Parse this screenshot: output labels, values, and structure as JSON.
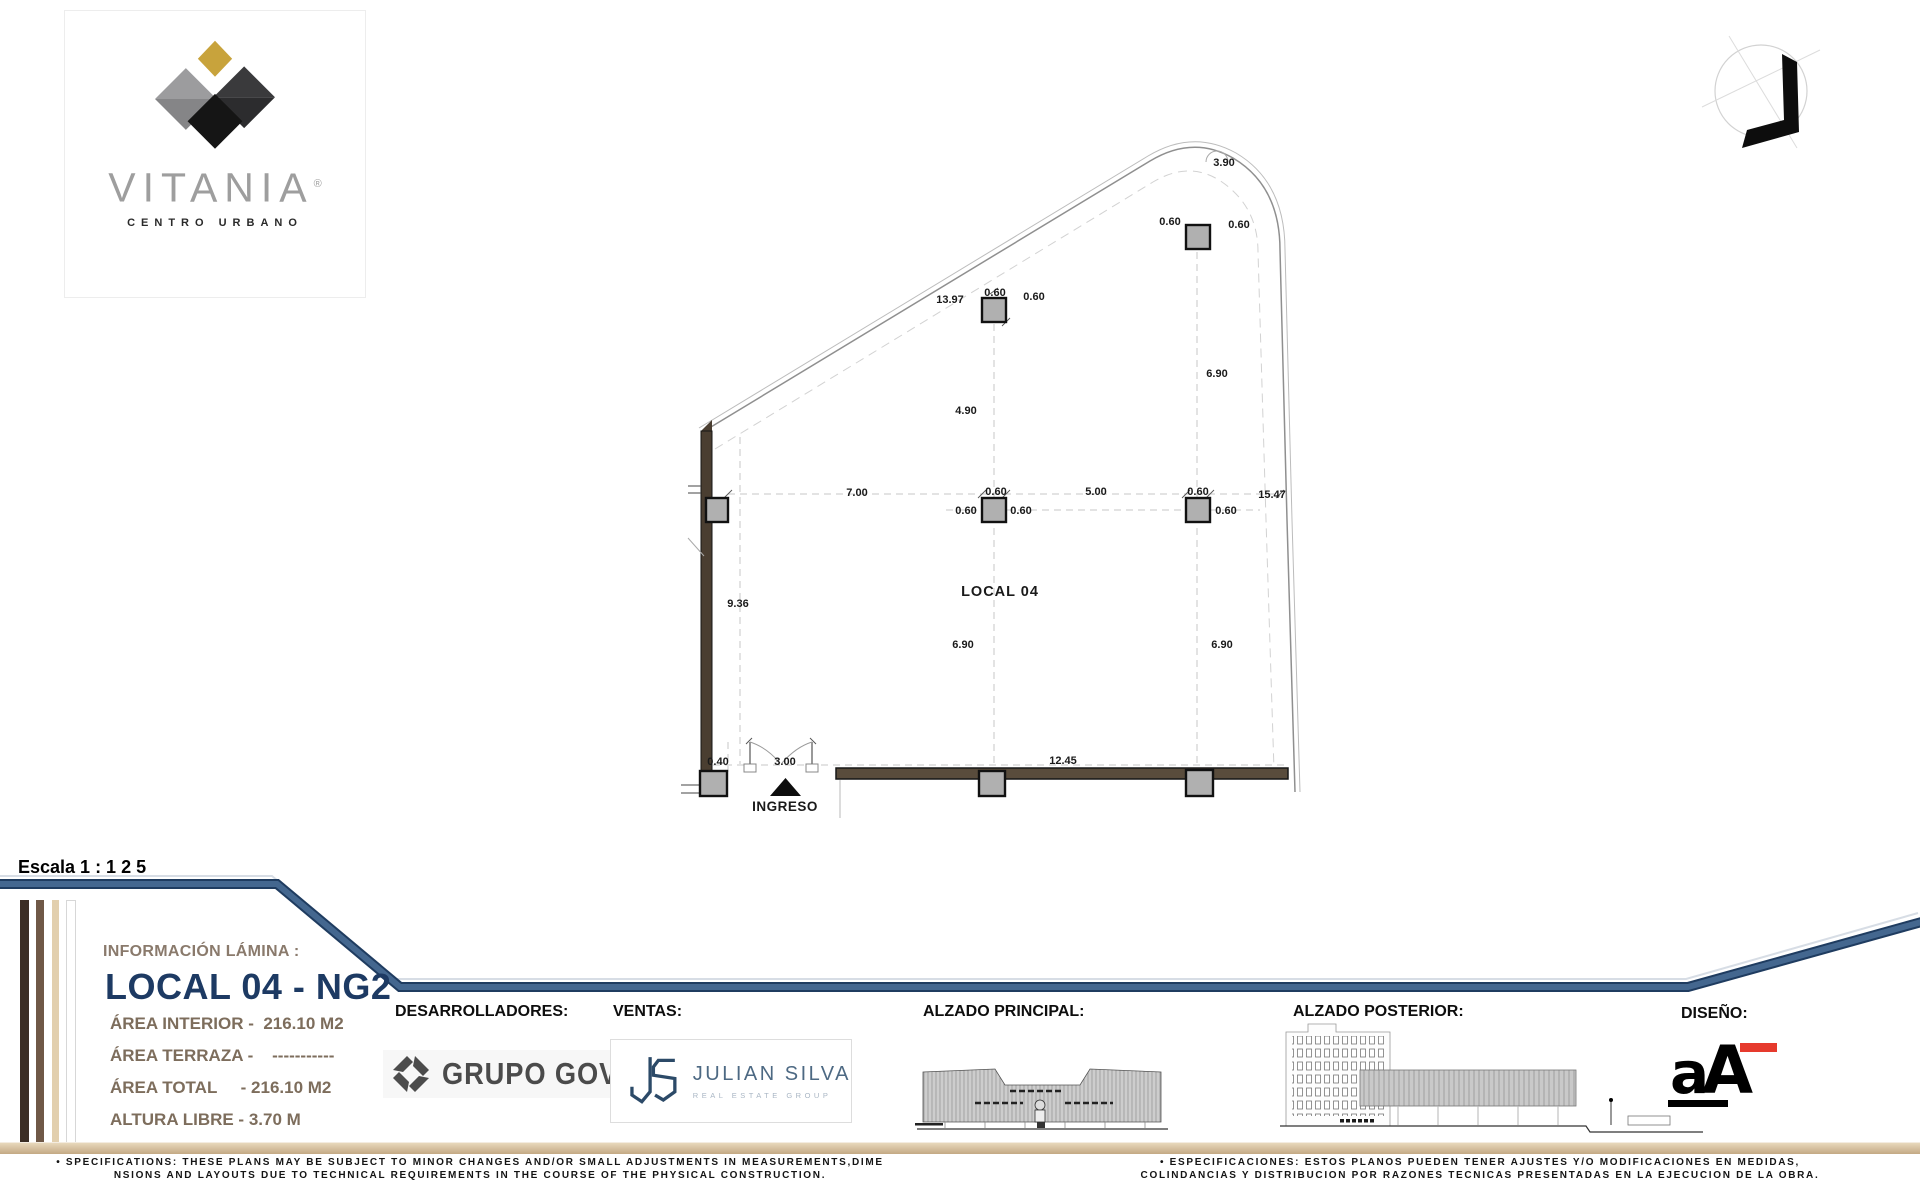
{
  "brand": {
    "name": "VITANIA",
    "registered": "®",
    "tagline": "CENTRO URBANO"
  },
  "scale_label": "Escala 1 : 1 2 5",
  "plan": {
    "labels": [
      {
        "t": "3.90",
        "x": 1224,
        "y": 166
      },
      {
        "t": "13.97",
        "x": 950,
        "y": 303
      },
      {
        "t": "0.60",
        "x": 995,
        "y": 296
      },
      {
        "t": "0.60",
        "x": 1034,
        "y": 300
      },
      {
        "t": "0.60",
        "x": 1170,
        "y": 225
      },
      {
        "t": "0.60",
        "x": 1239,
        "y": 228
      },
      {
        "t": "6.90",
        "x": 1217,
        "y": 377
      },
      {
        "t": "4.90",
        "x": 966,
        "y": 414
      },
      {
        "t": "7.00",
        "x": 857,
        "y": 496
      },
      {
        "t": "5.00",
        "x": 1096,
        "y": 495
      },
      {
        "t": "15.47",
        "x": 1272,
        "y": 498
      },
      {
        "t": "0.60",
        "x": 996,
        "y": 495
      },
      {
        "t": "0.60",
        "x": 966,
        "y": 514
      },
      {
        "t": "0.60",
        "x": 1021,
        "y": 514
      },
      {
        "t": "0.60",
        "x": 1198,
        "y": 495
      },
      {
        "t": "0.60",
        "x": 1226,
        "y": 514
      },
      {
        "t": "9.36",
        "x": 738,
        "y": 607
      },
      {
        "t": "6.90",
        "x": 963,
        "y": 648
      },
      {
        "t": "6.90",
        "x": 1222,
        "y": 648
      },
      {
        "t": "0.40",
        "x": 718,
        "y": 765
      },
      {
        "t": "3.00",
        "x": 785,
        "y": 765
      },
      {
        "t": "12.45",
        "x": 1063,
        "y": 764
      },
      {
        "t": "LOCAL 04",
        "x": 1000,
        "y": 596,
        "cls": "room"
      },
      {
        "t": "INGRESO",
        "x": 785,
        "y": 811,
        "cls": "entrance"
      }
    ]
  },
  "info_panel": {
    "heading": "INFORMACIÓN LÁMINA :",
    "title": "LOCAL 04 - NG2",
    "rows": [
      "ÁREA INTERIOR -  216.10 M2",
      "ÁREA TERRAZA -    -----------",
      "ÁREA TOTAL     - 216.10 M2",
      "ALTURA LIBRE - 3.70 M"
    ]
  },
  "sections": {
    "developers_label": "DESARROLLADORES:",
    "sales_label": "VENTAS:",
    "front_elevation_label": "ALZADO PRINCIPAL:",
    "rear_elevation_label": "ALZADO POSTERIOR:",
    "design_label": "DISEÑO:"
  },
  "logos": {
    "developer_name": "GRUPO GOVA",
    "sales_name": "JULIAN SILVA",
    "sales_subtitle": "REAL ESTATE GROUP",
    "design_a": "a",
    "design_cap": "A"
  },
  "footer": {
    "specs_en": [
      "• SPECIFICATIONS: THESE PLANS MAY BE SUBJECT TO MINOR CHANGES AND/OR SMALL ADJUSTMENTS IN MEASUREMENTS,DIME",
      "NSIONS AND LAYOUTS DUE TO TECHNICAL REQUIREMENTS IN THE COURSE OF THE PHYSICAL CONSTRUCTION."
    ],
    "specs_es": [
      "• ESPECIFICACIONES: ESTOS PLANOS PUEDEN TENER AJUSTES Y/O MODIFICACIONES EN MEDIDAS,",
      "COLINDANCIAS Y DISTRIBUCION POR RAZONES TECNICAS PRESENTADAS EN LA EJECUCION DE LA OBRA."
    ]
  },
  "colors": {
    "accent_blue": "#44678f",
    "navy_title": "#1d3a63",
    "brown_text": "#7d6d5c",
    "gold": "#c8a33c",
    "wall_brown": "#4a3e31",
    "tan_bar": "#d3bc96",
    "logo_red": "#e63a2d"
  }
}
